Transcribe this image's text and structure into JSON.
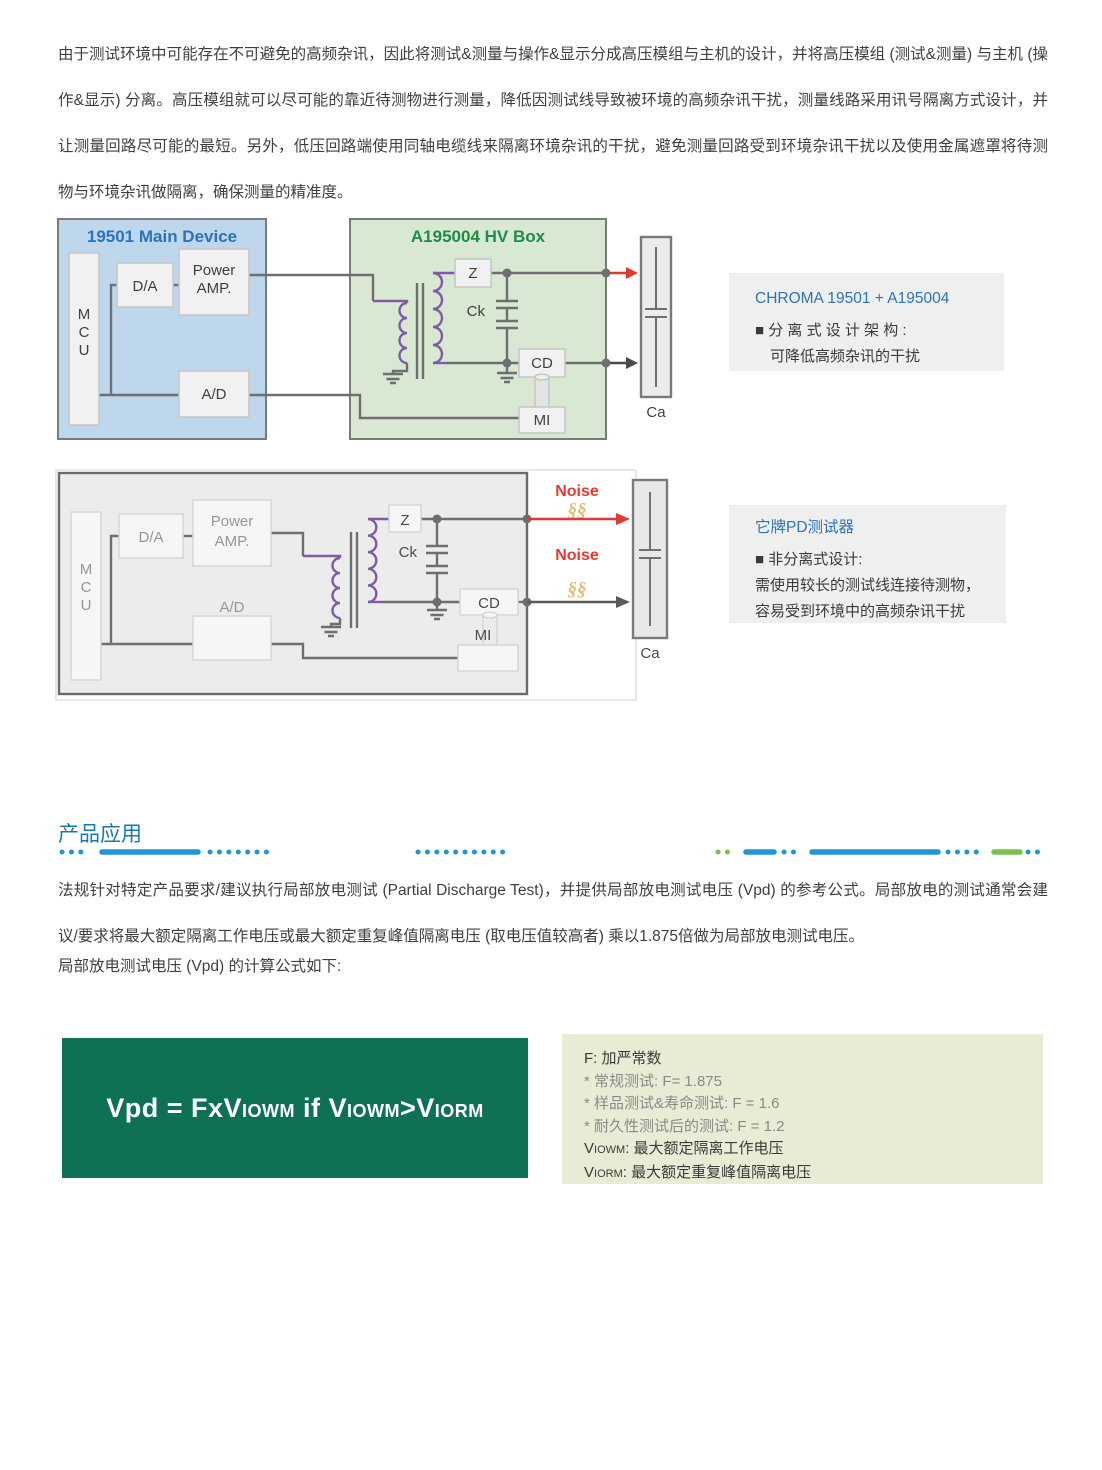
{
  "intro": "由于测试环境中可能存在不可避免的高频杂讯，因此将测试&测量与操作&显示分成高压模组与主机的设计，并将高压模组 (测试&测量) 与主机 (操作&显示) 分离。高压模组就可以尽可能的靠近待测物进行测量，降低因测试线导致被环境的高频杂讯干扰，测量线路采用讯号隔离方式设计，并让测量回路尽可能的最短。另外，低压回路端使用同轴电缆线来隔离环境杂讯的干扰，避免测量回路受到环境杂讯干扰以及使用金属遮罩将待测物与环境杂讯做隔离，确保测量的精准度。",
  "d1": {
    "main_title": "19501 Main Device",
    "hv_title": "A195004 HV Box",
    "mcu": [
      "M",
      "C",
      "U"
    ],
    "da": "D/A",
    "pamp": [
      "Power",
      "AMP."
    ],
    "ad": "A/D",
    "z": "Z",
    "ck": "Ck",
    "cd": "CD",
    "mi": "MI",
    "ca": "Ca"
  },
  "note1": {
    "title": "CHROMA 19501 + A195004",
    "line1": "■ 分 离 式 设 计 架 构 :",
    "line2": "可降低高频杂讯的干扰"
  },
  "d2": {
    "mcu": [
      "M",
      "C",
      "U"
    ],
    "da": "D/A",
    "pamp": [
      "Power",
      "AMP."
    ],
    "ad": "A/D",
    "z": "Z",
    "ck": "Ck",
    "cd": "CD",
    "mi": "MI",
    "ca": "Ca",
    "noise1": "Noise",
    "noise2": "Noise",
    "ss1": "§§",
    "ss2": "§§"
  },
  "note2": {
    "title": "它牌PD测试器",
    "line1": "■ 非分离式设计:",
    "line2": "需使用较长的测试线连接待测物，",
    "line3": "容易受到环境中的高频杂讯干扰"
  },
  "section_title": "产品应用",
  "para2": "法规针对特定产品要求/建议执行局部放电测试 (Partial Discharge Test)，并提供局部放电测试电压 (Vpd) 的参考公式。局部放电的测试通常会建议/要求将最大额定隔离工作电压或最大额定重复峰值隔离电压 (取电压值较高者) 乘以1.875倍做为局部放电测试电压。",
  "formula_intro": "局部放电测试电压 (Vpd) 的计算公式如下:",
  "formula": {
    "p1": "Vpd = FxV",
    "s1": "IOWM",
    "p2": " if V",
    "s2": "IOWM",
    "p3": ">V",
    "s3": "IORM"
  },
  "legend": {
    "l1": "F: 加严常数",
    "l2": "* 常规测试: F= 1.875",
    "l3": "* 样品测试&寿命测试: F = 1.6",
    "l4": "* 耐久性测试后的测试: F = 1.2",
    "l5v": "V",
    "l5s": "IOWM",
    "l5t": ": 最大额定隔离工作电压",
    "l6v": "V",
    "l6s": "IORM",
    "l6t": ": 最大额定重复峰值隔离电压"
  },
  "colors": {
    "accent_blue": "#2e73b8",
    "accent_green": "#1e8c4a",
    "noise_red": "#e8392e",
    "wire_gray": "#6f6f6f",
    "transformer_purple": "#7e5ba6",
    "formula_bg": "#0e7156",
    "legend_bg": "#e8ecd4",
    "note_bg": "#efefef",
    "divider_blue": "#2196d6",
    "divider_green": "#7cc24a"
  }
}
